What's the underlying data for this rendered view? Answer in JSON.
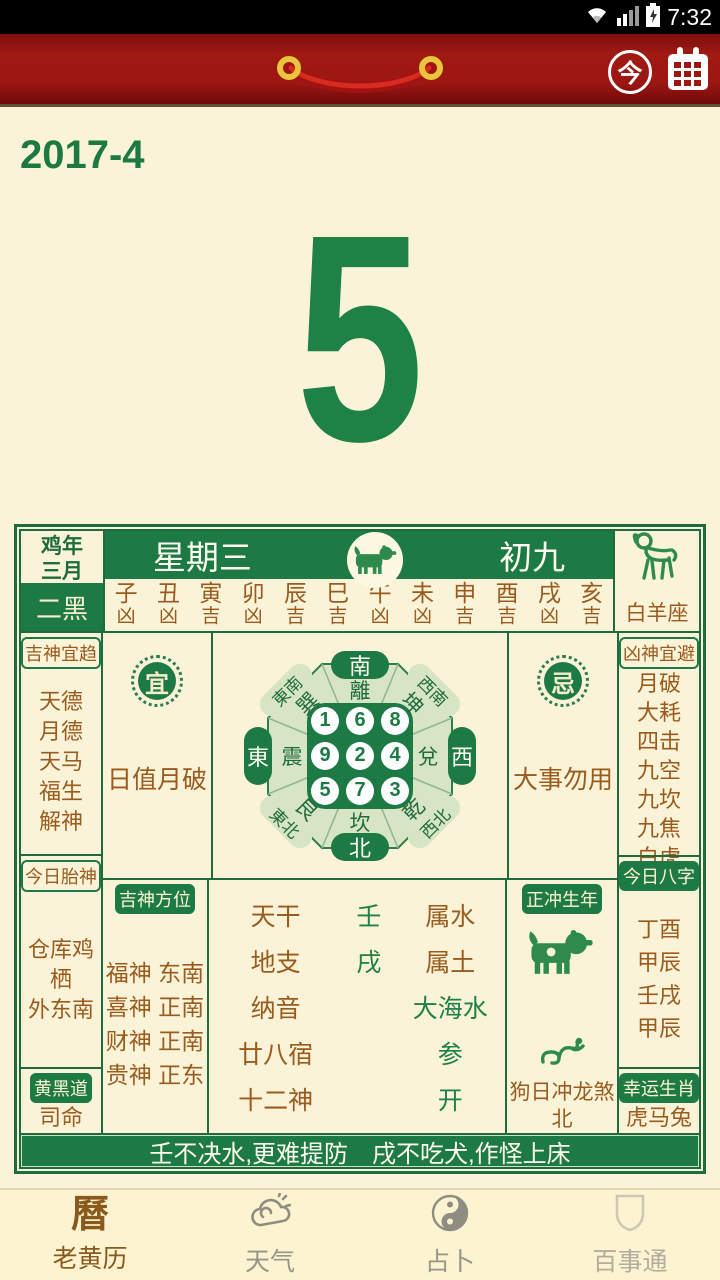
{
  "colors": {
    "green": "#1e7a45",
    "dark_green_border": "#1e6b3d",
    "brown": "#9a5b1e",
    "cream": "#faf3d8",
    "header_red": "#9c1712",
    "nav_active": "#8a591c"
  },
  "status_bar": {
    "time": "7:32"
  },
  "header": {
    "today_label": "今"
  },
  "date": {
    "year_month": "2017-4",
    "day": "5"
  },
  "card": {
    "year_cell": {
      "line1": "鸡年",
      "line2": "三月",
      "star": "二黑"
    },
    "weekday": "星期三",
    "lunar_day": "初九",
    "zodiac_sign": "白羊座",
    "branches": [
      {
        "name": "子",
        "luck": "凶"
      },
      {
        "name": "丑",
        "luck": "凶"
      },
      {
        "name": "寅",
        "luck": "吉"
      },
      {
        "name": "卯",
        "luck": "凶"
      },
      {
        "name": "辰",
        "luck": "吉"
      },
      {
        "name": "巳",
        "luck": "吉"
      },
      {
        "name": "午",
        "luck": "凶"
      },
      {
        "name": "未",
        "luck": "凶"
      },
      {
        "name": "申",
        "luck": "吉"
      },
      {
        "name": "酉",
        "luck": "吉"
      },
      {
        "name": "戌",
        "luck": "凶"
      },
      {
        "name": "亥",
        "luck": "吉"
      }
    ],
    "left": {
      "good_gods_title": "吉神宜趋",
      "good_gods": "天德\n月德\n天马\n福生\n解神",
      "fetal_god_title": "今日胎神",
      "fetal_god": "仓库鸡栖\n外东南",
      "path_title": "黄黑道",
      "path_value": "司命"
    },
    "right": {
      "bad_gods_title": "凶神宜避",
      "bad_gods": "月破\n大耗\n四击\n九空\n九坎\n九焦\n白虎",
      "bazi_title": "今日八字",
      "bazi": "丁酉\n甲辰\n壬戌\n甲辰",
      "lucky_title": "幸运生肖",
      "lucky": "虎马兔"
    },
    "yi": {
      "seal": "宜",
      "text": "日值月破"
    },
    "ji": {
      "seal": "忌",
      "text": "大事勿用"
    },
    "compass": {
      "dirs": {
        "top": "南",
        "bottom": "北",
        "left": "東",
        "right": "西",
        "top_left": "東南",
        "top_right": "西南",
        "bottom_left": "東北",
        "bottom_right": "西北"
      },
      "trigrams": {
        "top": "離",
        "bottom": "坎",
        "left": "震",
        "right": "兌",
        "top_left": "巽",
        "top_right": "坤",
        "bottom_left": "艮",
        "bottom_right": "乾"
      },
      "grid": [
        "1",
        "6",
        "8",
        "9",
        "2",
        "4",
        "5",
        "7",
        "3"
      ]
    },
    "gods_directions": {
      "title": "吉神方位",
      "lines": "福神 东南\n喜神 正南\n财神 正南\n贵神 正东"
    },
    "ganzhi": [
      {
        "label": "天干",
        "value": "壬",
        "attr": "属水"
      },
      {
        "label": "地支",
        "value": "戌",
        "attr": "属土"
      },
      {
        "label": "纳音",
        "value": "",
        "attr": "大海水"
      },
      {
        "label": "廿八宿",
        "value": "",
        "attr": "参"
      },
      {
        "label": "十二神",
        "value": "",
        "attr": "开"
      }
    ],
    "clash": {
      "title": "正冲生年",
      "text": "狗日冲龙煞\n北"
    },
    "saying": "壬不决水,更难提防　戌不吃犬,作怪上床"
  },
  "nav": {
    "items": [
      {
        "label": "老黄历"
      },
      {
        "label": "天气"
      },
      {
        "label": "占卜"
      },
      {
        "label": "百事通"
      }
    ]
  }
}
